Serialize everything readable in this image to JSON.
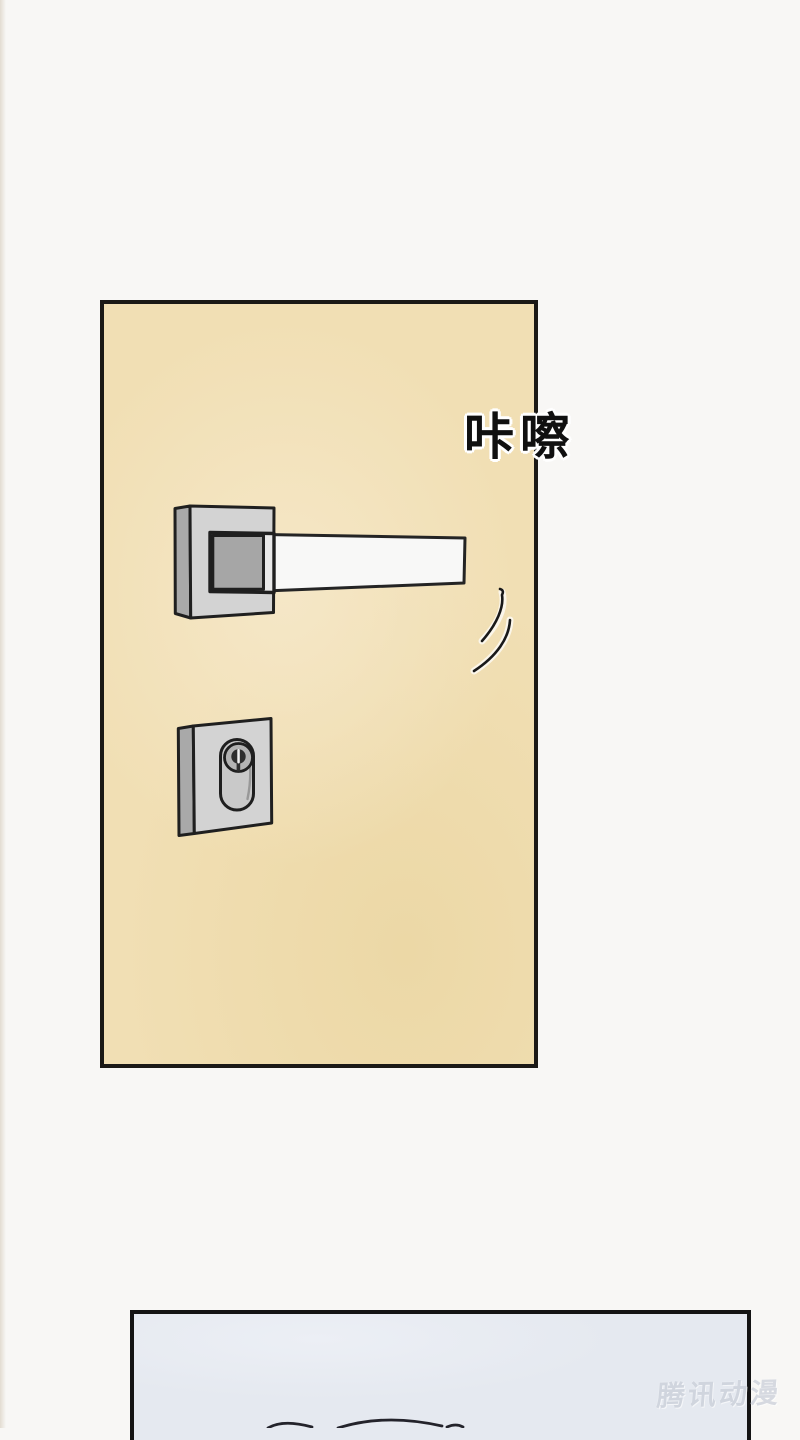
{
  "page": {
    "width": 800,
    "height": 1428
  },
  "sfx": {
    "text": "咔嚓"
  },
  "watermark": {
    "text": "腾讯动漫"
  },
  "illustrations": {
    "door_handle": "square-rosette-lever-door-handle",
    "door_lock": "keyhole-escutcheon-plate",
    "motion_lines": "handle-turning-motion-lines",
    "bottom_panel_hint": "top-of-head-hair-outline"
  },
  "colors": {
    "page_bg": "#f8f7f5",
    "door_panel_bg": "#f1dfb4",
    "door_panel_bg_light": "#f5e7c7",
    "door_panel_bg_dark": "#ecd8a6",
    "panel_border": "#1b1916",
    "metal_light": "#d3d3d3",
    "metal_mid": "#a9a9a9",
    "metal_inner": "#a6a6a6",
    "metal_strip": "#e9e9e9",
    "lever_fill": "#f8f8f7",
    "pill_fill": "#c9c9c9",
    "cylinder_fill": "#b3b3b3",
    "outline": "#1f1f1f",
    "keyhole": "#2e2e2e",
    "keyhole_slit": "#f2f2f2",
    "bottom_panel_bg": "#e5e9f0",
    "bottom_panel_bg_light": "#eceff5",
    "sfx_color": "#101010",
    "sfx_outline": "#ffffff",
    "watermark_color": "#c9ced8",
    "hair_line": "#23232b"
  }
}
